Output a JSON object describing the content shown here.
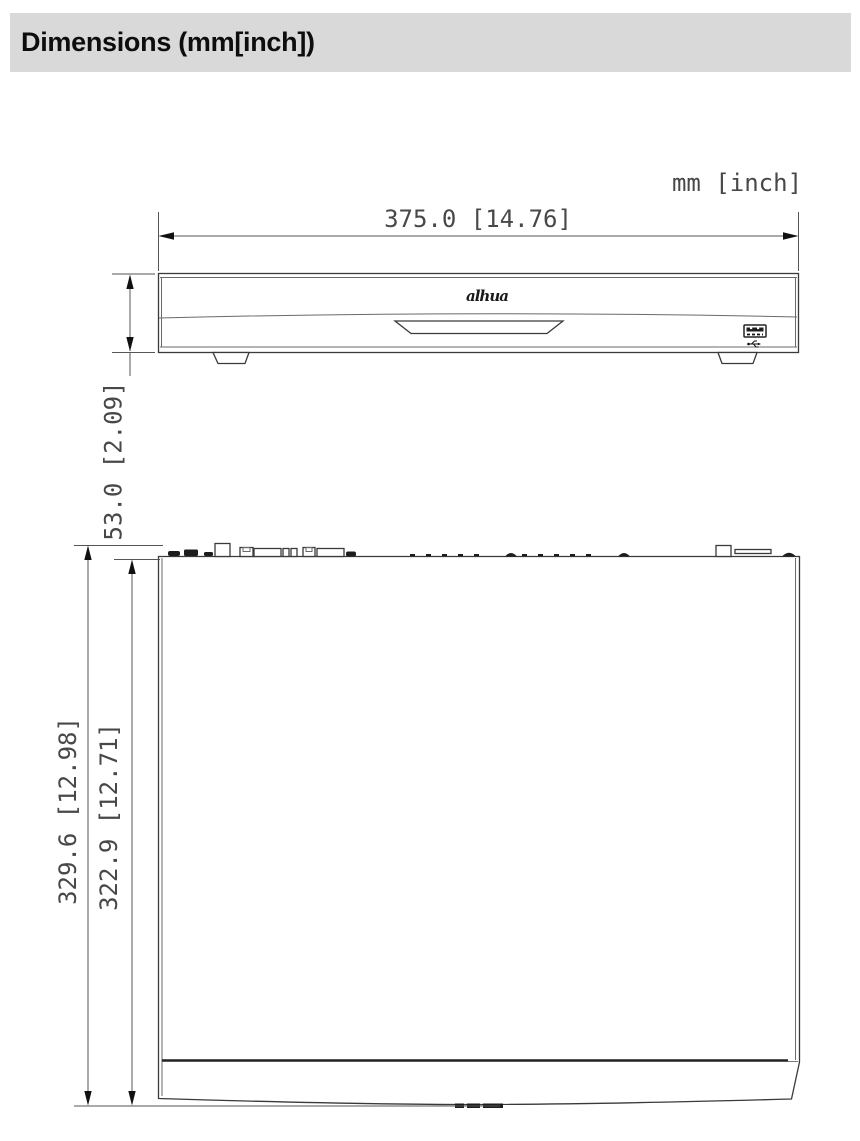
{
  "header": {
    "title": "Dimensions (mm[inch])"
  },
  "drawing": {
    "units_label": "mm [inch]",
    "logo_text": "alhua",
    "front_view": {
      "width_label": "375.0 [14.76]",
      "height_label": "53.0 [2.09]"
    },
    "top_view": {
      "depth_outer_label": "329.6 [12.98]",
      "depth_inner_label": "322.9 [12.71]"
    }
  }
}
